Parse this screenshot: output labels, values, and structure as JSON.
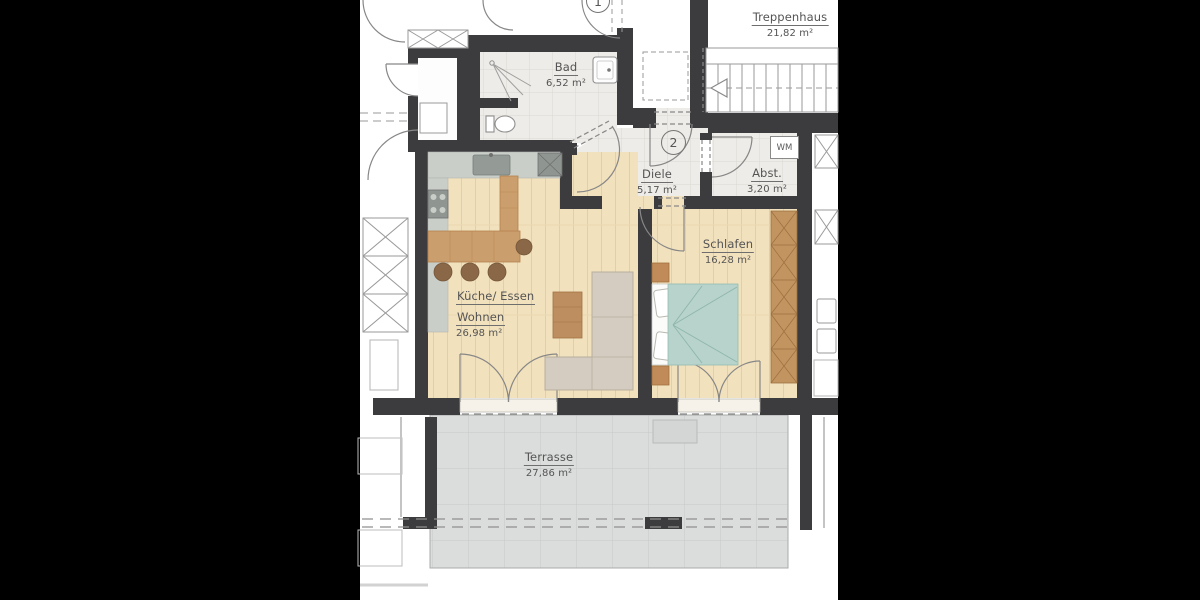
{
  "colors": {
    "background": "#000000",
    "paper": "#ffffff",
    "wall": "#3c3c3e",
    "wood_floor": "#f2e1bd",
    "tile_floor": "#eeece8",
    "terrace_paving": "#dbdddc",
    "furniture_wood": "#c99c6b",
    "sofa": "#d4ccc0",
    "bed_blanket": "#b7d3cb",
    "kitchen_counter": "#c9cec9",
    "label_text": "#545454"
  },
  "units": {
    "unit1_badge": "1",
    "unit2_badge": "2"
  },
  "appliances": {
    "washing_machine": "WM"
  },
  "rooms": {
    "treppenhaus": {
      "name": "Treppenhaus",
      "area": "21,82 m²"
    },
    "bad": {
      "name": "Bad",
      "area": "6,52 m²"
    },
    "diele": {
      "name": "Diele",
      "area": "5,17 m²"
    },
    "abstellraum": {
      "name": "Abst.",
      "area": "3,20 m²"
    },
    "schlafen": {
      "name": "Schlafen",
      "area": "16,28 m²"
    },
    "wohnen": {
      "name": "Küche/ Essen",
      "name_line2": "Wohnen",
      "area": "26,98 m²"
    },
    "terrasse": {
      "name": "Terrasse",
      "area": "27,86 m²"
    }
  }
}
